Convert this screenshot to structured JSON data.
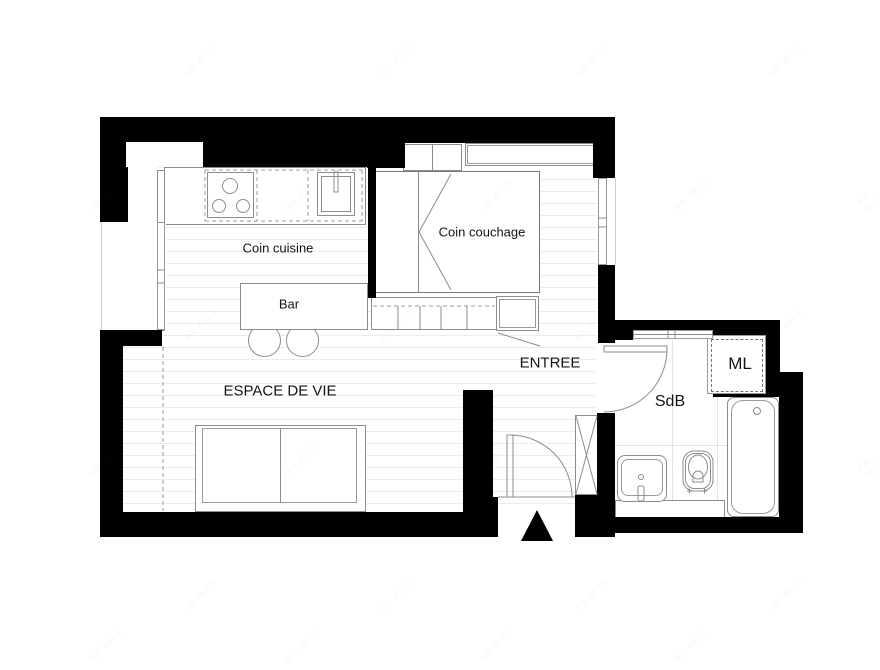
{
  "plan": {
    "type": "studio apartment floor plan",
    "labels": {
      "cuisine": "Coin cuisine",
      "couchage": "Coin couchage",
      "bar": "Bar",
      "vie": "ESPACE DE VIE",
      "entree": "ENTREE",
      "sdb": "SdB",
      "ml": "ML"
    },
    "colors": {
      "wall": "#000000",
      "furniture_line": "#8c8c8c",
      "floor_stripe": "#ececec",
      "label_text": "#141414",
      "background": "#ffffff"
    }
  },
  "watermark": {
    "text": "mh deco",
    "positions": [
      [
        180,
        55
      ],
      [
        375,
        55
      ],
      [
        570,
        55
      ],
      [
        765,
        55
      ],
      [
        85,
        190
      ],
      [
        280,
        190
      ],
      [
        475,
        190
      ],
      [
        670,
        190
      ],
      [
        858,
        190
      ],
      [
        180,
        320
      ],
      [
        375,
        320
      ],
      [
        570,
        320
      ],
      [
        765,
        320
      ],
      [
        85,
        455
      ],
      [
        280,
        455
      ],
      [
        475,
        455
      ],
      [
        670,
        455
      ],
      [
        858,
        455
      ],
      [
        180,
        590
      ],
      [
        375,
        590
      ],
      [
        570,
        590
      ],
      [
        765,
        590
      ],
      [
        85,
        640
      ],
      [
        280,
        640
      ],
      [
        475,
        640
      ],
      [
        670,
        640
      ]
    ]
  }
}
